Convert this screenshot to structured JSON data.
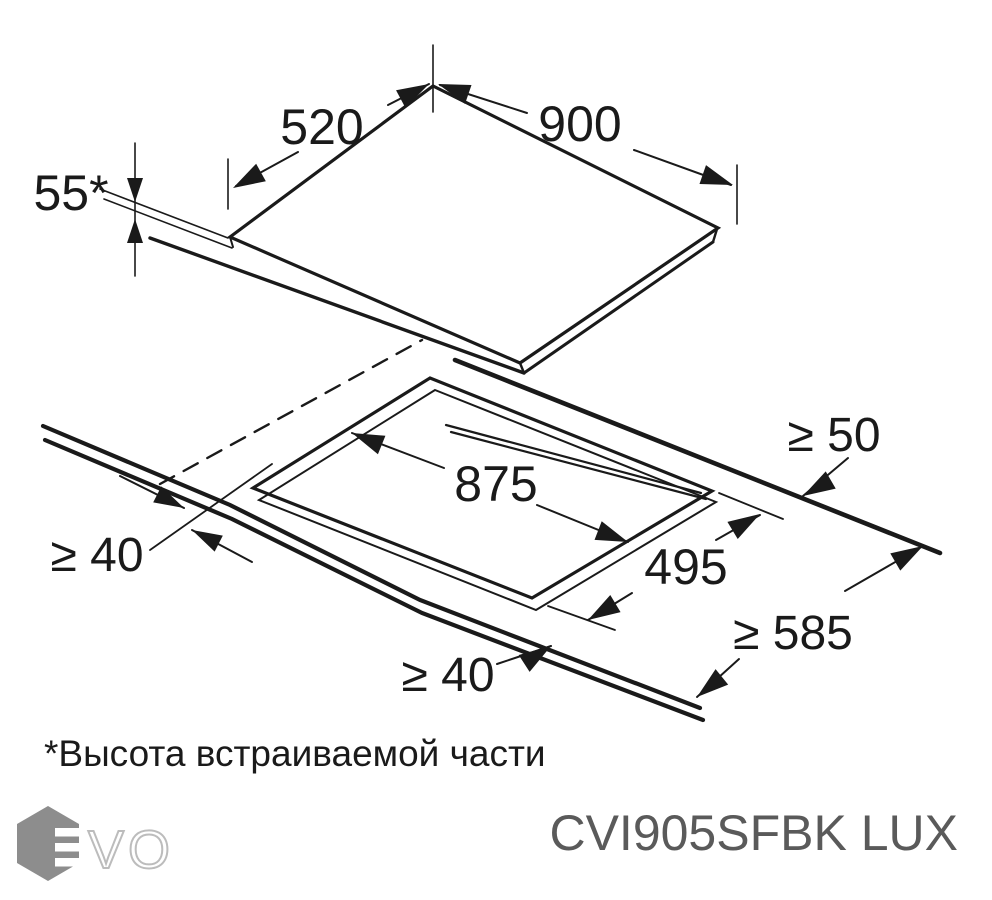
{
  "diagram": {
    "type": "installation-drawing",
    "labels": {
      "top_width": "520",
      "top_length": "900",
      "built_in_height": "55*",
      "cutout_length": "875",
      "cutout_width": "495",
      "rear_clearance": "≥ 50",
      "worktop_depth": "≥ 585",
      "front_clearance": "≥ 40",
      "left_clearance": "≥ 40"
    }
  },
  "footnote": "*Высота встраиваемой части",
  "model": "CVI905SFBK LUX",
  "logo": {
    "vo_text": "VO"
  },
  "colors": {
    "line": "#1a1a1a",
    "model_text": "#5a5a5a",
    "logo_hexagon": "#8d8d8d",
    "logo_vo_outline": "#bcbcbc"
  }
}
